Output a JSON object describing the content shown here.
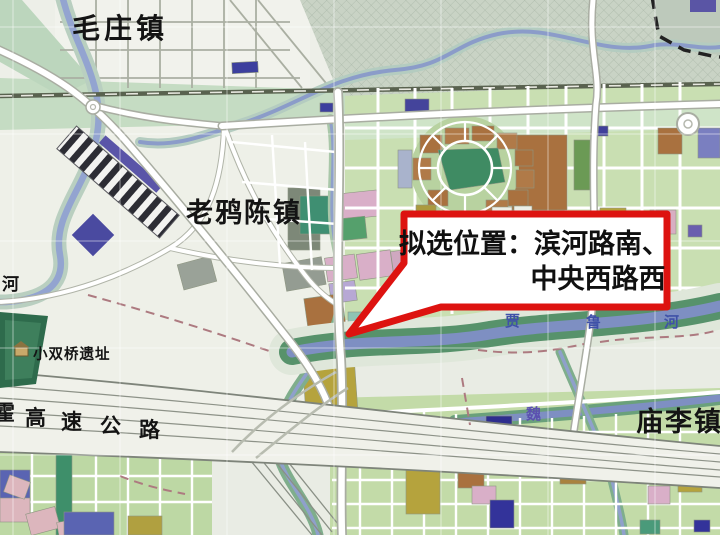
{
  "map": {
    "town_labels": [
      {
        "id": "maozhuang",
        "text": "毛庄镇"
      },
      {
        "id": "laoyachen",
        "text": "老鸦陈镇"
      },
      {
        "id": "miaoli",
        "text": "庙李镇"
      }
    ],
    "site_label": "小双桥遗址",
    "left_river_label": "河",
    "wei_river_label": "魏",
    "highway_chars": [
      "霍",
      "高",
      "速",
      "公",
      "路"
    ],
    "river_chars": [
      "贾",
      "鲁",
      "河"
    ],
    "colors": {
      "callout_border": "#dd1310",
      "water": "#8496c6",
      "river_bank_green": "#57926b",
      "parcel_green": "#c9dfb2",
      "parcel_brown": "#a9713f",
      "parcel_olive": "#b5a33d",
      "parcel_pink": "#d9afc8",
      "parcel_blue": "#3c3f9e",
      "hatch_area": "#c9d3c5",
      "label_black": "#141414",
      "wei_label_purple": "#5b50b0",
      "river_label_blue": "#3f51a8"
    }
  },
  "callout": {
    "line1": "拟选位置：滨河路南、",
    "line2": "中央西路西"
  }
}
